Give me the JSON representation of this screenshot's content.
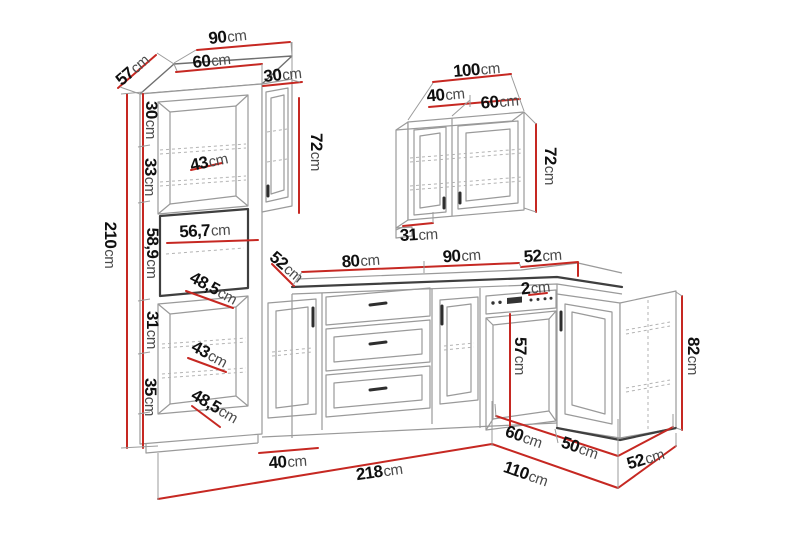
{
  "diagram": {
    "kind": "kitchen-furniture-dimension-drawing",
    "background": "#ffffff",
    "colors": {
      "dimension_line": "#c62822",
      "number_text": "#101010",
      "unit_text": "#4a4a4a",
      "outline_light": "#9a9a9a",
      "outline_dark": "#3f3f3f"
    },
    "unit": "cm",
    "dims": {
      "tall_top_total_width": {
        "value": "90",
        "unit": "cm"
      },
      "tall_top_main_width": {
        "value": "60",
        "unit": "cm"
      },
      "tall_top_depth": {
        "value": "57",
        "unit": "cm"
      },
      "tall_top_side_width": {
        "value": "30",
        "unit": "cm"
      },
      "tall_upper_section1_height": {
        "value": "30",
        "unit": "cm"
      },
      "tall_upper_section2_height": {
        "value": "33",
        "unit": "cm"
      },
      "tall_upper_door_width": {
        "value": "43",
        "unit": "cm"
      },
      "side_wall_cab_height": {
        "value": "72",
        "unit": "cm"
      },
      "tall_niche_width": {
        "value": "56,7",
        "unit": "cm"
      },
      "tall_niche_height": {
        "value": "58,9",
        "unit": "cm"
      },
      "counter_left_depth": {
        "value": "52",
        "unit": "cm"
      },
      "tall_lower_inner_width_a": {
        "value": "48,5",
        "unit": "cm"
      },
      "tall_lower_section1_height": {
        "value": "31",
        "unit": "cm"
      },
      "tall_lower_door_width": {
        "value": "43",
        "unit": "cm"
      },
      "tall_lower_section2_height": {
        "value": "35",
        "unit": "cm"
      },
      "tall_lower_inner_width_b": {
        "value": "48,5",
        "unit": "cm"
      },
      "tall_total_height": {
        "value": "210",
        "unit": "cm"
      },
      "base_cab_width": {
        "value": "40",
        "unit": "cm"
      },
      "wall_cab_total_width": {
        "value": "100",
        "unit": "cm"
      },
      "wall_cab_door1_width": {
        "value": "40",
        "unit": "cm"
      },
      "wall_cab_door2_width": {
        "value": "60",
        "unit": "cm"
      },
      "wall_cab_height": {
        "value": "72",
        "unit": "cm"
      },
      "wall_cab_depth": {
        "value": "31",
        "unit": "cm"
      },
      "counter_section1_width": {
        "value": "80",
        "unit": "cm"
      },
      "counter_section2_width": {
        "value": "90",
        "unit": "cm"
      },
      "counter_corner_depth": {
        "value": "52",
        "unit": "cm"
      },
      "counter_overhang": {
        "value": "2",
        "unit": "cm"
      },
      "oven_door_height": {
        "value": "57",
        "unit": "cm"
      },
      "right_run_height": {
        "value": "82",
        "unit": "cm"
      },
      "right_run_cab1_width": {
        "value": "60",
        "unit": "cm"
      },
      "right_run_cab2_width": {
        "value": "50",
        "unit": "cm"
      },
      "right_run_end_depth": {
        "value": "52",
        "unit": "cm"
      },
      "right_run_total_length": {
        "value": "110",
        "unit": "cm"
      },
      "left_run_total_length": {
        "value": "218",
        "unit": "cm"
      }
    }
  }
}
